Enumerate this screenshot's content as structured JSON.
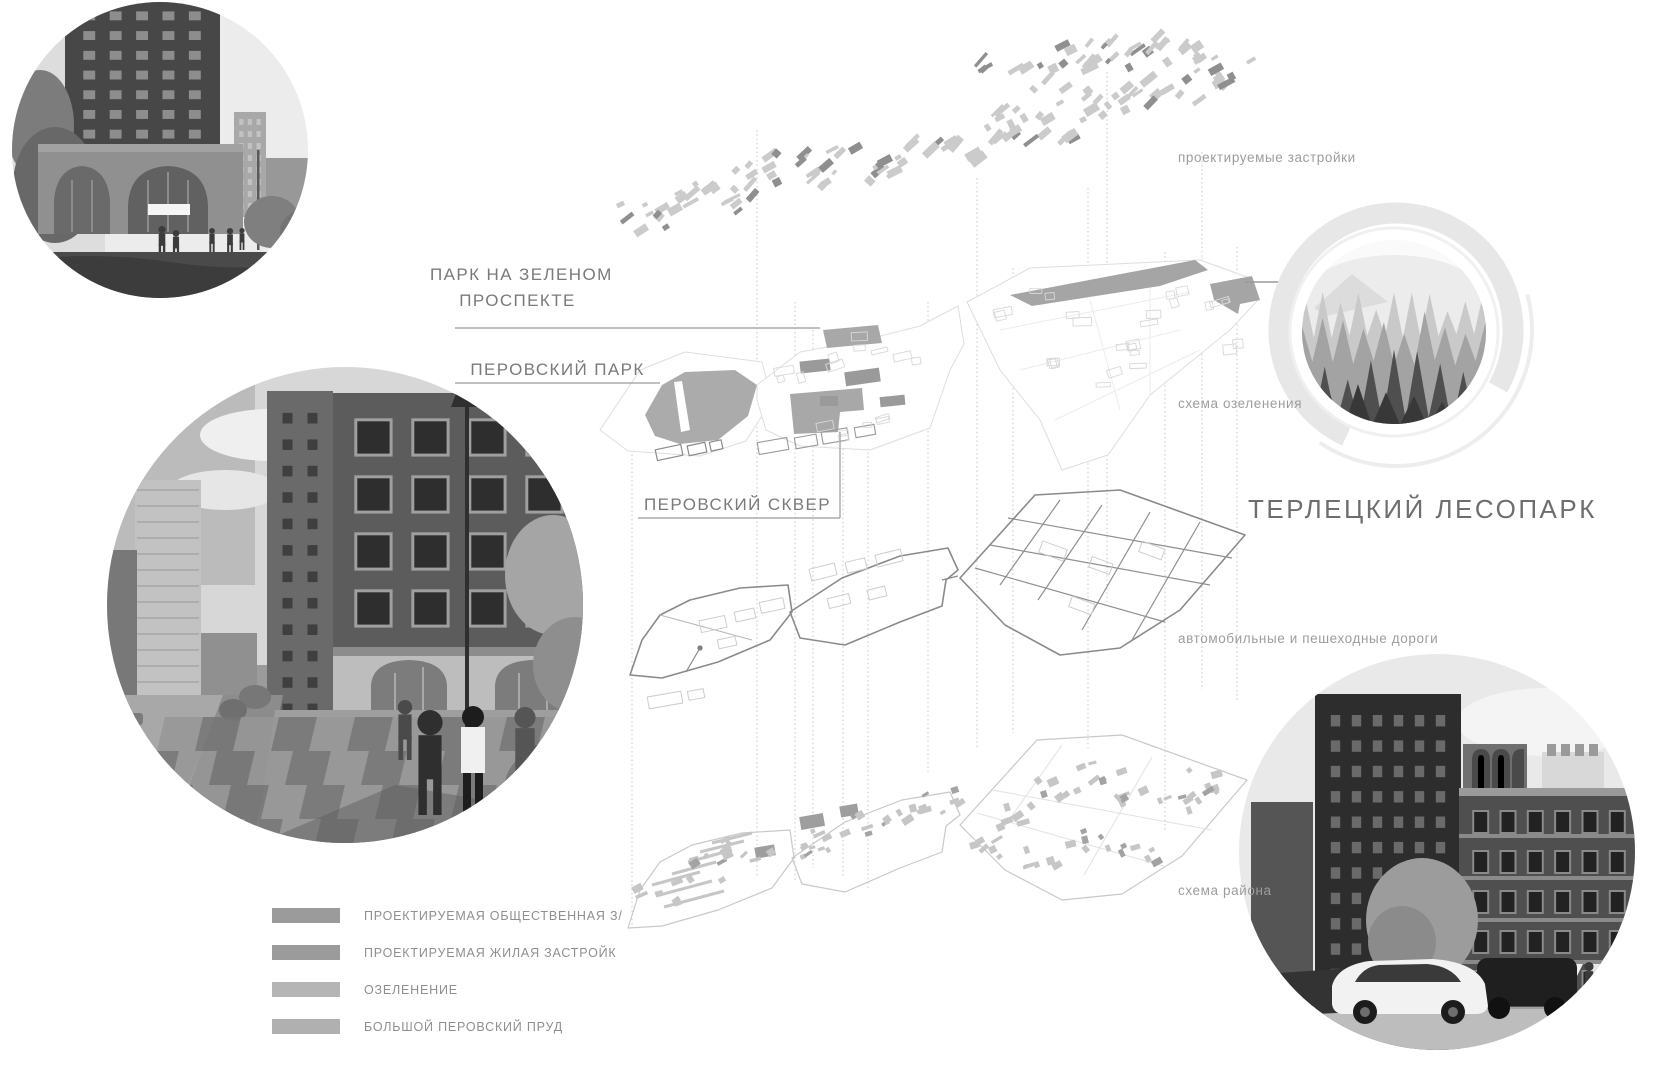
{
  "board": {
    "title": "ТЕРЛЕЦКИЙ ЛЕСОПАРК"
  },
  "annotations": {
    "park_on_green_prospekt": {
      "line1": "ПАРК НА ЗЕЛЕНОМ",
      "line2": "ПРОСПЕКТЕ"
    },
    "perovsky_park": "ПЕРОВСКИЙ ПАРК",
    "perovsky_square": "ПЕРОВСКИЙ СКВЕР"
  },
  "layer_captions": {
    "projected_buildings": "проектируемые застройки",
    "greenery_scheme": "схема озеленения",
    "roads": "автомобильные и пешеходные дороги",
    "district_scheme": "схема района"
  },
  "legend": {
    "items": [
      {
        "label": "ПРОЕКТИРУЕМАЯ ОБЩЕСТВЕННАЯ З/",
        "swatch": "#9b9b9b"
      },
      {
        "label": "ПРОЕКТИРУЕМАЯ ЖИЛАЯ ЗАСТРОЙК",
        "swatch": "#9b9b9b"
      },
      {
        "label": "ОЗЕЛЕНЕНИЕ",
        "swatch": "#b5b5b5"
      },
      {
        "label": "БОЛЬШОЙ ПЕРОВСКИЙ ПРУД",
        "swatch": "#b0b0b0"
      }
    ]
  },
  "colors": {
    "background": "#ffffff",
    "label_text": "#7a7a7a",
    "caption_text": "#9d9d9d",
    "title_text": "#6e6e6e",
    "legend_text": "#8f8f8f",
    "leader_line": "#9a9a9a",
    "guide_line": "#c6c6c6",
    "diagram_light": "#cbcbcb",
    "diagram_dark": "#8f8f8f",
    "plan_green_fill": "#a8a8a8"
  }
}
